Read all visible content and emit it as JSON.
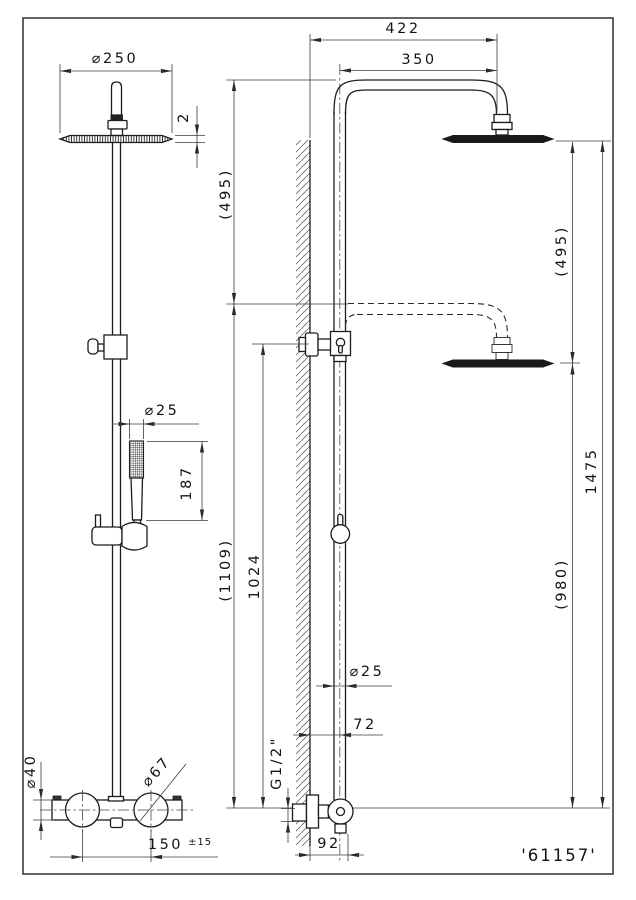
{
  "part_number": "'61157'",
  "line_color": "#1c1c1c",
  "front_view": {
    "head_diameter": "⌀250",
    "head_thickness": "2",
    "handshower_diameter": "⌀25",
    "handshower_length": "187",
    "body_diameter": "⌀40",
    "handle_diameter": "⌀67",
    "inlet_spacing": "150",
    "inlet_spacing_tolerance": "±15"
  },
  "side_view": {
    "arm_projection": "422",
    "arm_projection_center": "350",
    "travel_upper": "(495)",
    "travel_head": "(495)",
    "overall_height": "1475",
    "lowered_head_height": "(980)",
    "column_top_height": "(1109)",
    "bracket_height": "1024",
    "column_diameter": "⌀25",
    "column_wall_offset": "72",
    "inlet_thread": "G1/2\"",
    "wall_to_valve": "92"
  }
}
